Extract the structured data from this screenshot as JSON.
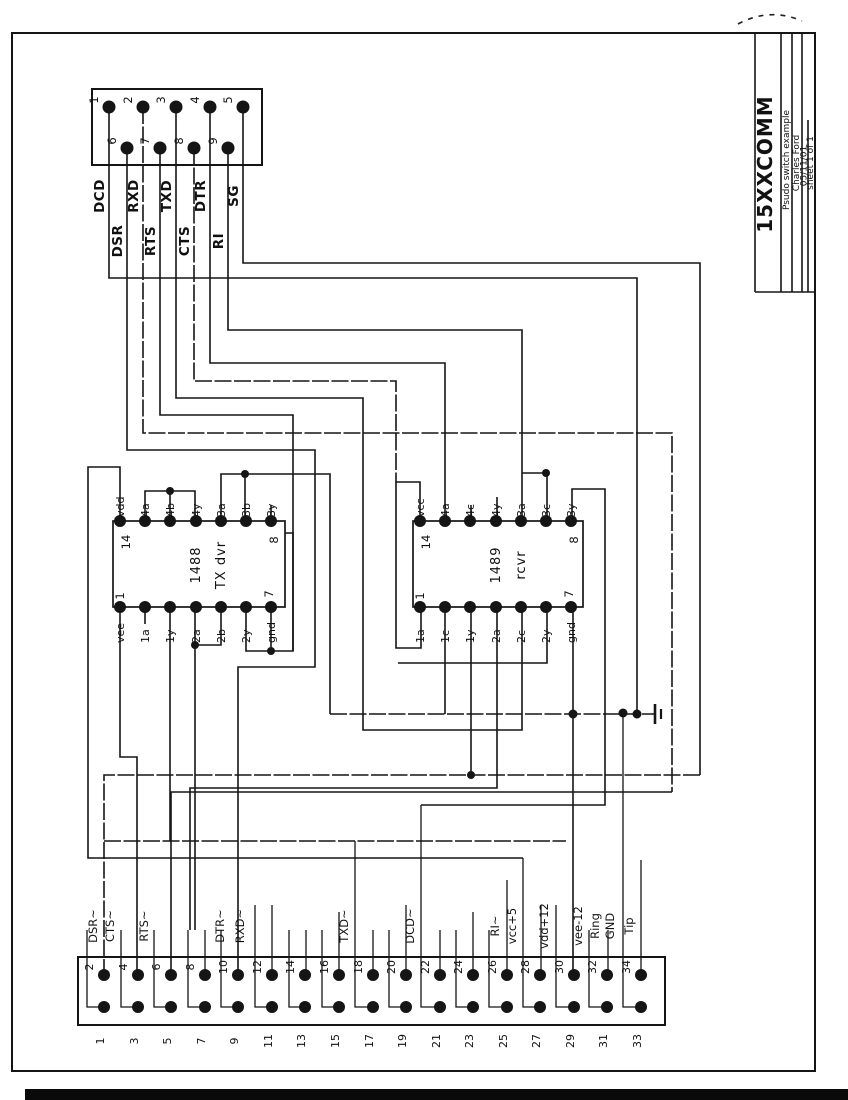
{
  "title_block": {
    "title": "15XXCOMM",
    "subtitle": "Psudo switch example",
    "author": "Charles Ford",
    "date": "05/11/01",
    "sheet": "sheet 1 of 1"
  },
  "db9_connector": {
    "pin_numbers_row1": [
      "1",
      "2",
      "3",
      "4",
      "5"
    ],
    "pin_numbers_row2": [
      "6",
      "7",
      "8",
      "9"
    ],
    "signals": [
      {
        "name": "DCD",
        "row": 1
      },
      {
        "name": "DSR",
        "row": 2
      },
      {
        "name": "RXD",
        "row": 1
      },
      {
        "name": "RTS",
        "row": 2
      },
      {
        "name": "TXD",
        "row": 1
      },
      {
        "name": "CTS",
        "row": 2
      },
      {
        "name": "DTR",
        "row": 1
      },
      {
        "name": "RI",
        "row": 2
      },
      {
        "name": "SG",
        "row": 1
      }
    ]
  },
  "ic_1488": {
    "part": "1488",
    "role": "TX dvr",
    "top_pin_labels": [
      "vdd",
      "4a",
      "4b",
      "4y",
      "3a",
      "3b",
      "3y"
    ],
    "bottom_pin_labels": [
      "vee",
      "1a",
      "1y",
      "2a",
      "2b",
      "2y",
      "gnd"
    ],
    "corner_numbers": {
      "top_left": "14",
      "top_right": "8",
      "bottom_left": "1",
      "bottom_right": "7"
    }
  },
  "ic_1489": {
    "part": "1489",
    "role": "rcvr",
    "top_pin_labels": [
      "vcc",
      "4a",
      "4c",
      "4y",
      "3a",
      "3c",
      "3y"
    ],
    "bottom_pin_labels": [
      "1a",
      "1c",
      "1y",
      "2a",
      "2c",
      "2y",
      "gnd"
    ],
    "corner_numbers": {
      "top_left": "14",
      "top_right": "8",
      "bottom_left": "1",
      "bottom_right": "7"
    }
  },
  "header_connector": {
    "even_pin_numbers": [
      "2",
      "4",
      "6",
      "8",
      "10",
      "12",
      "14",
      "16",
      "18",
      "20",
      "22",
      "24",
      "26",
      "28",
      "30",
      "32",
      "34"
    ],
    "odd_pin_numbers": [
      "1",
      "3",
      "5",
      "7",
      "9",
      "11",
      "13",
      "15",
      "17",
      "19",
      "21",
      "23",
      "25",
      "27",
      "29",
      "31",
      "33"
    ],
    "signal_labels": [
      "DSR~",
      "CTS~",
      "RTS~",
      "DTR~",
      "RXD~",
      "TXD~",
      "DCD~",
      "RI~",
      "vcc+5",
      "vdd+12",
      "vee-12",
      "Ring",
      "GND",
      "Tip"
    ]
  }
}
